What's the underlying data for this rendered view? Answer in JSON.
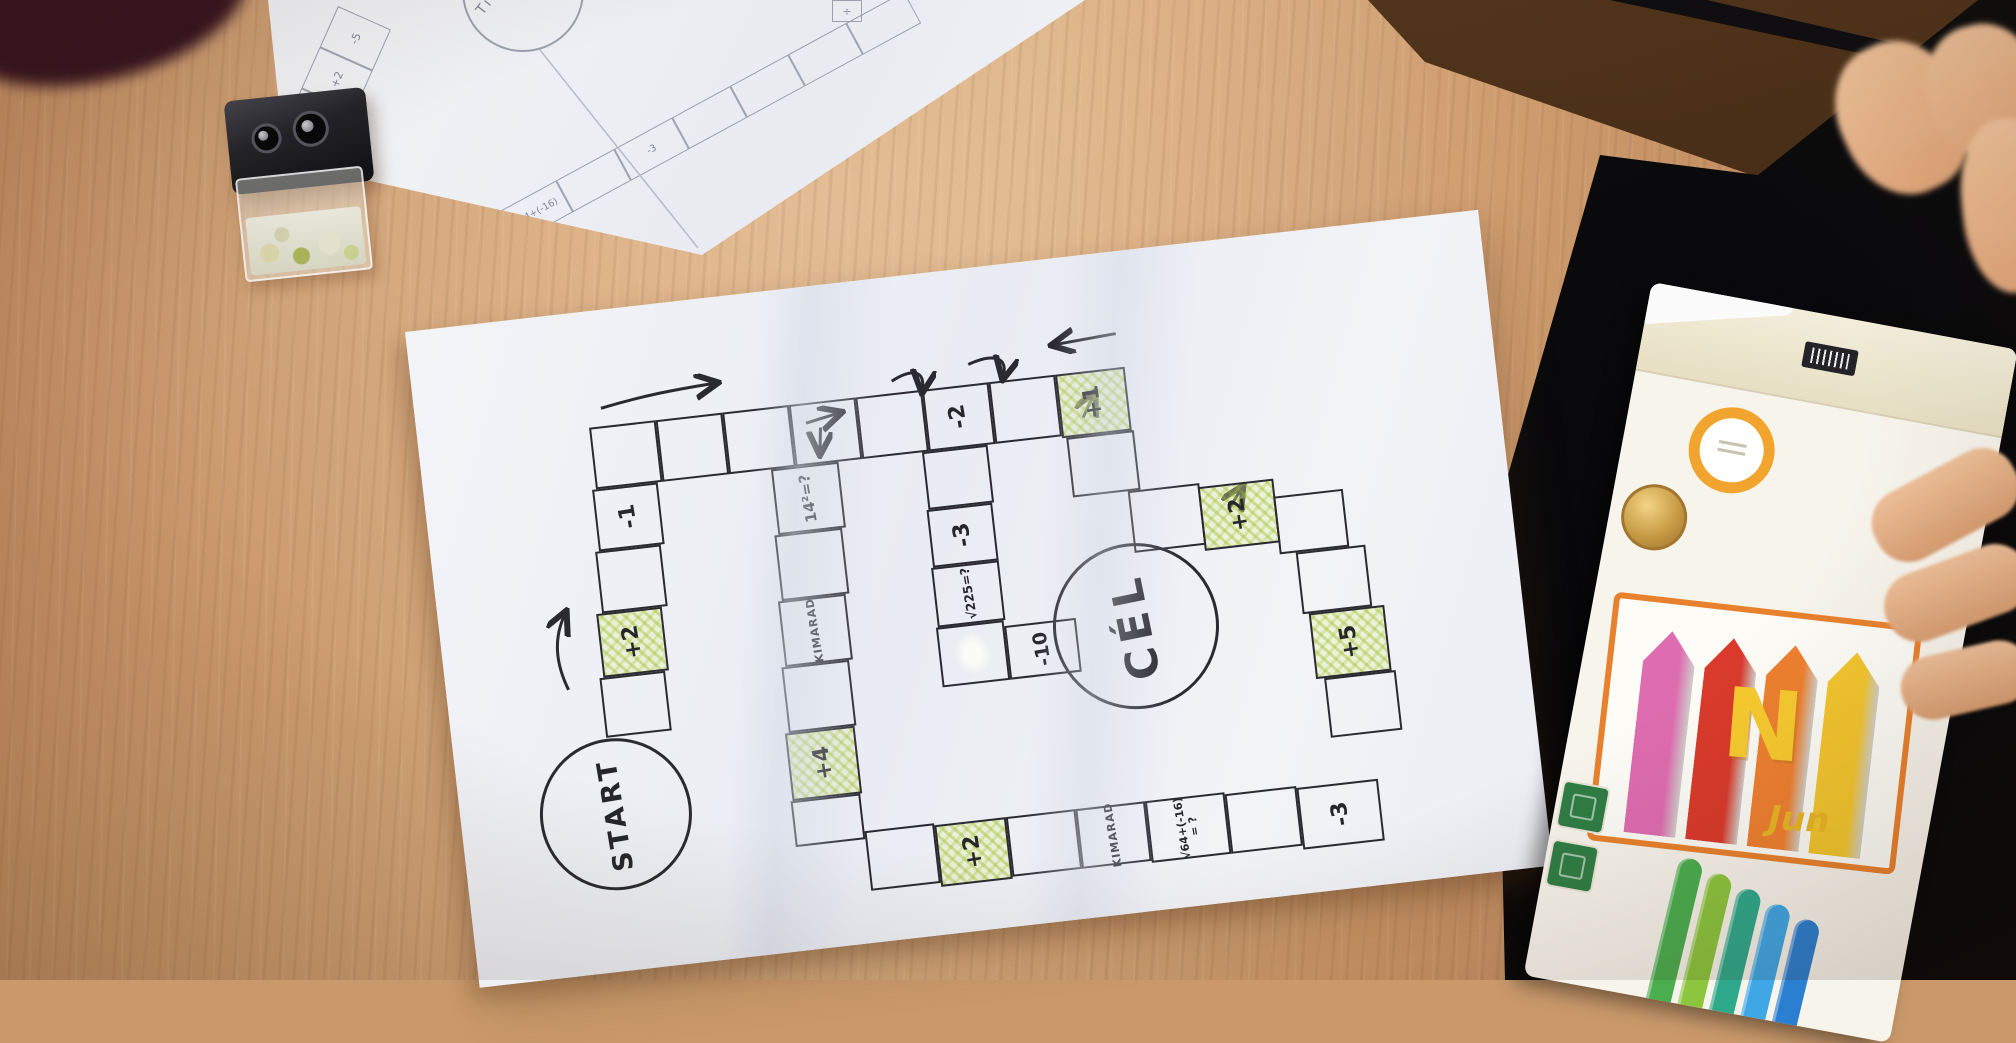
{
  "main_board": {
    "start_label": "START",
    "goal_label": "CÉL",
    "cells": [
      {
        "id": "t0",
        "label": ""
      },
      {
        "id": "t1",
        "label": ""
      },
      {
        "id": "t2",
        "label": ""
      },
      {
        "id": "t3",
        "label": ""
      },
      {
        "id": "t4",
        "label": ""
      },
      {
        "id": "t5",
        "label": "-2"
      },
      {
        "id": "t6",
        "label": ""
      },
      {
        "id": "t7",
        "label": "+1",
        "highlight": true
      },
      {
        "id": "l0",
        "label": "-1"
      },
      {
        "id": "l1",
        "label": ""
      },
      {
        "id": "l2",
        "label": "+2",
        "highlight": true
      },
      {
        "id": "l3",
        "label": ""
      },
      {
        "id": "a0",
        "label": "14²=?"
      },
      {
        "id": "a1",
        "label": ""
      },
      {
        "id": "a2",
        "label": "KIMARAD"
      },
      {
        "id": "a3",
        "label": ""
      },
      {
        "id": "a4",
        "label": "+4",
        "highlight": true
      },
      {
        "id": "a5",
        "label": ""
      },
      {
        "id": "b0",
        "label": ""
      },
      {
        "id": "b1",
        "label": "+2",
        "highlight": true
      },
      {
        "id": "b2",
        "label": ""
      },
      {
        "id": "b3",
        "label": "KIMARAD"
      },
      {
        "id": "b4",
        "label": "√64+(-16)\n= ?"
      },
      {
        "id": "b5",
        "label": ""
      },
      {
        "id": "b6",
        "label": "-3"
      },
      {
        "id": "c0",
        "label": ""
      },
      {
        "id": "c1",
        "label": "-3"
      },
      {
        "id": "c2",
        "label": "√225=?"
      },
      {
        "id": "c3",
        "label": "",
        "whiteout": true
      },
      {
        "id": "d0",
        "label": "-10"
      },
      {
        "id": "r0",
        "label": ""
      },
      {
        "id": "r1",
        "label": ""
      },
      {
        "id": "r2",
        "label": "+2",
        "highlight": true
      },
      {
        "id": "r3",
        "label": ""
      },
      {
        "id": "r4",
        "label": ""
      },
      {
        "id": "r5",
        "label": "+5",
        "highlight": true
      },
      {
        "id": "r6",
        "label": ""
      }
    ]
  },
  "sketch_board": {
    "circle_label": "TiNI",
    "band1": [
      "-5",
      "+2",
      "",
      "+4",
      "KIMARAD"
    ],
    "band2": [
      "√64+(-16)",
      "",
      "-3",
      "",
      "",
      "",
      ""
    ],
    "corner_mark": "÷"
  },
  "stationery": {
    "green_pencil": {
      "code": "340396_1910",
      "brand_word1": "UNITED",
      "brand_word2": "OFFICE",
      "ce": "CE"
    },
    "fineliner": {
      "grade": "F"
    }
  },
  "pencil_box": {
    "brand_letter": "N",
    "brand_script": "Jun",
    "art_colors": [
      "#de6cb0",
      "#d93a2b",
      "#ee8030",
      "#f2c52e"
    ],
    "pencil_colors": [
      "#4aae4f",
      "#8cc63f",
      "#2fa98c",
      "#3fa7e6",
      "#2b7fd0"
    ]
  },
  "colors": {
    "highlight": "#cfe284",
    "ink": "#2a2a30",
    "paper": "#f1f2f5",
    "wood": "#c9996b",
    "pencil_sketch": "#8b909c"
  }
}
